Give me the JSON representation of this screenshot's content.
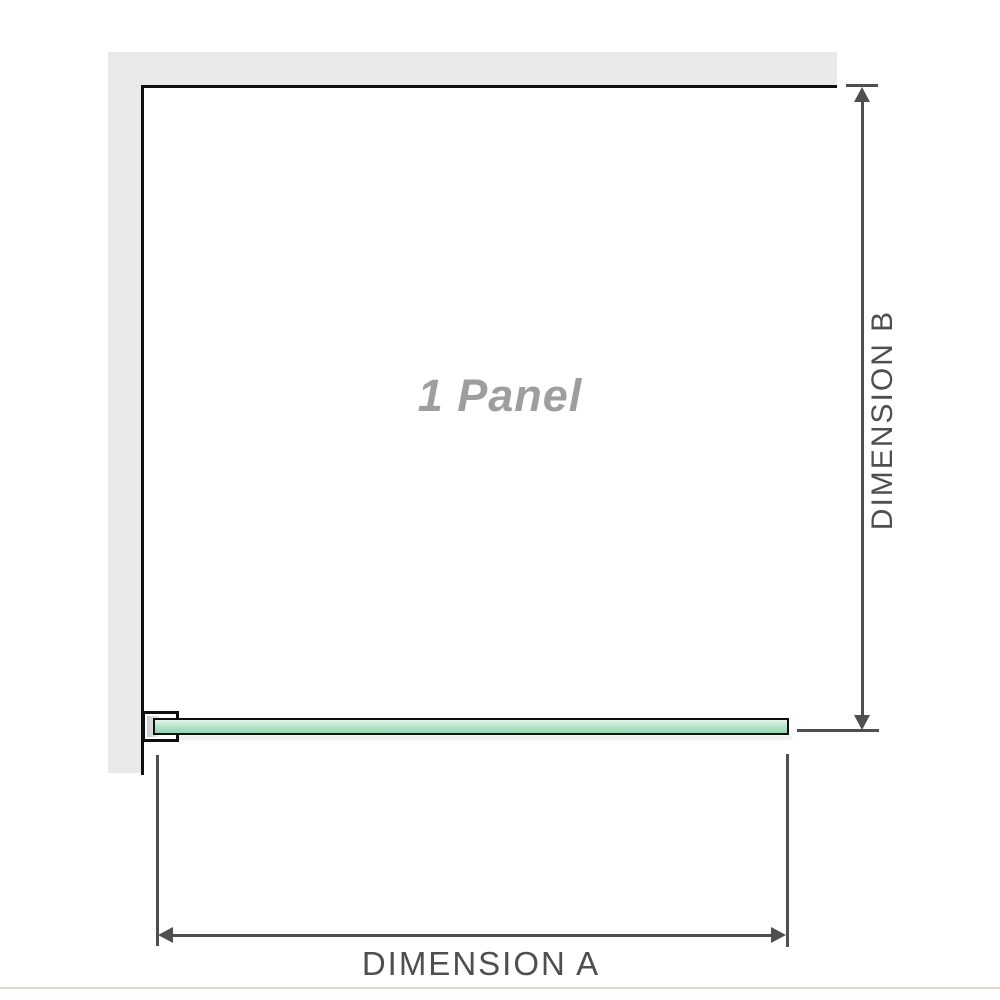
{
  "diagram": {
    "panel_label": "1 Panel",
    "dimension_a_label": "DIMENSION A",
    "dimension_b_label": "DIMENSION B"
  },
  "icons": {
    "arrow_up": "triangle-up",
    "arrow_down": "triangle-down",
    "arrow_left": "triangle-left",
    "arrow_right": "triangle-right"
  },
  "colors": {
    "wall": "#e9e9e9",
    "outline": "#0f0f0f",
    "dimension": "#4f4f4f",
    "panel_label": "#9e9e9e",
    "glass_light": "#e4f5e9",
    "glass_mid": "#b2e2c7",
    "glass_dark": "#94d5b3",
    "baseline": "#dbd7cf"
  }
}
